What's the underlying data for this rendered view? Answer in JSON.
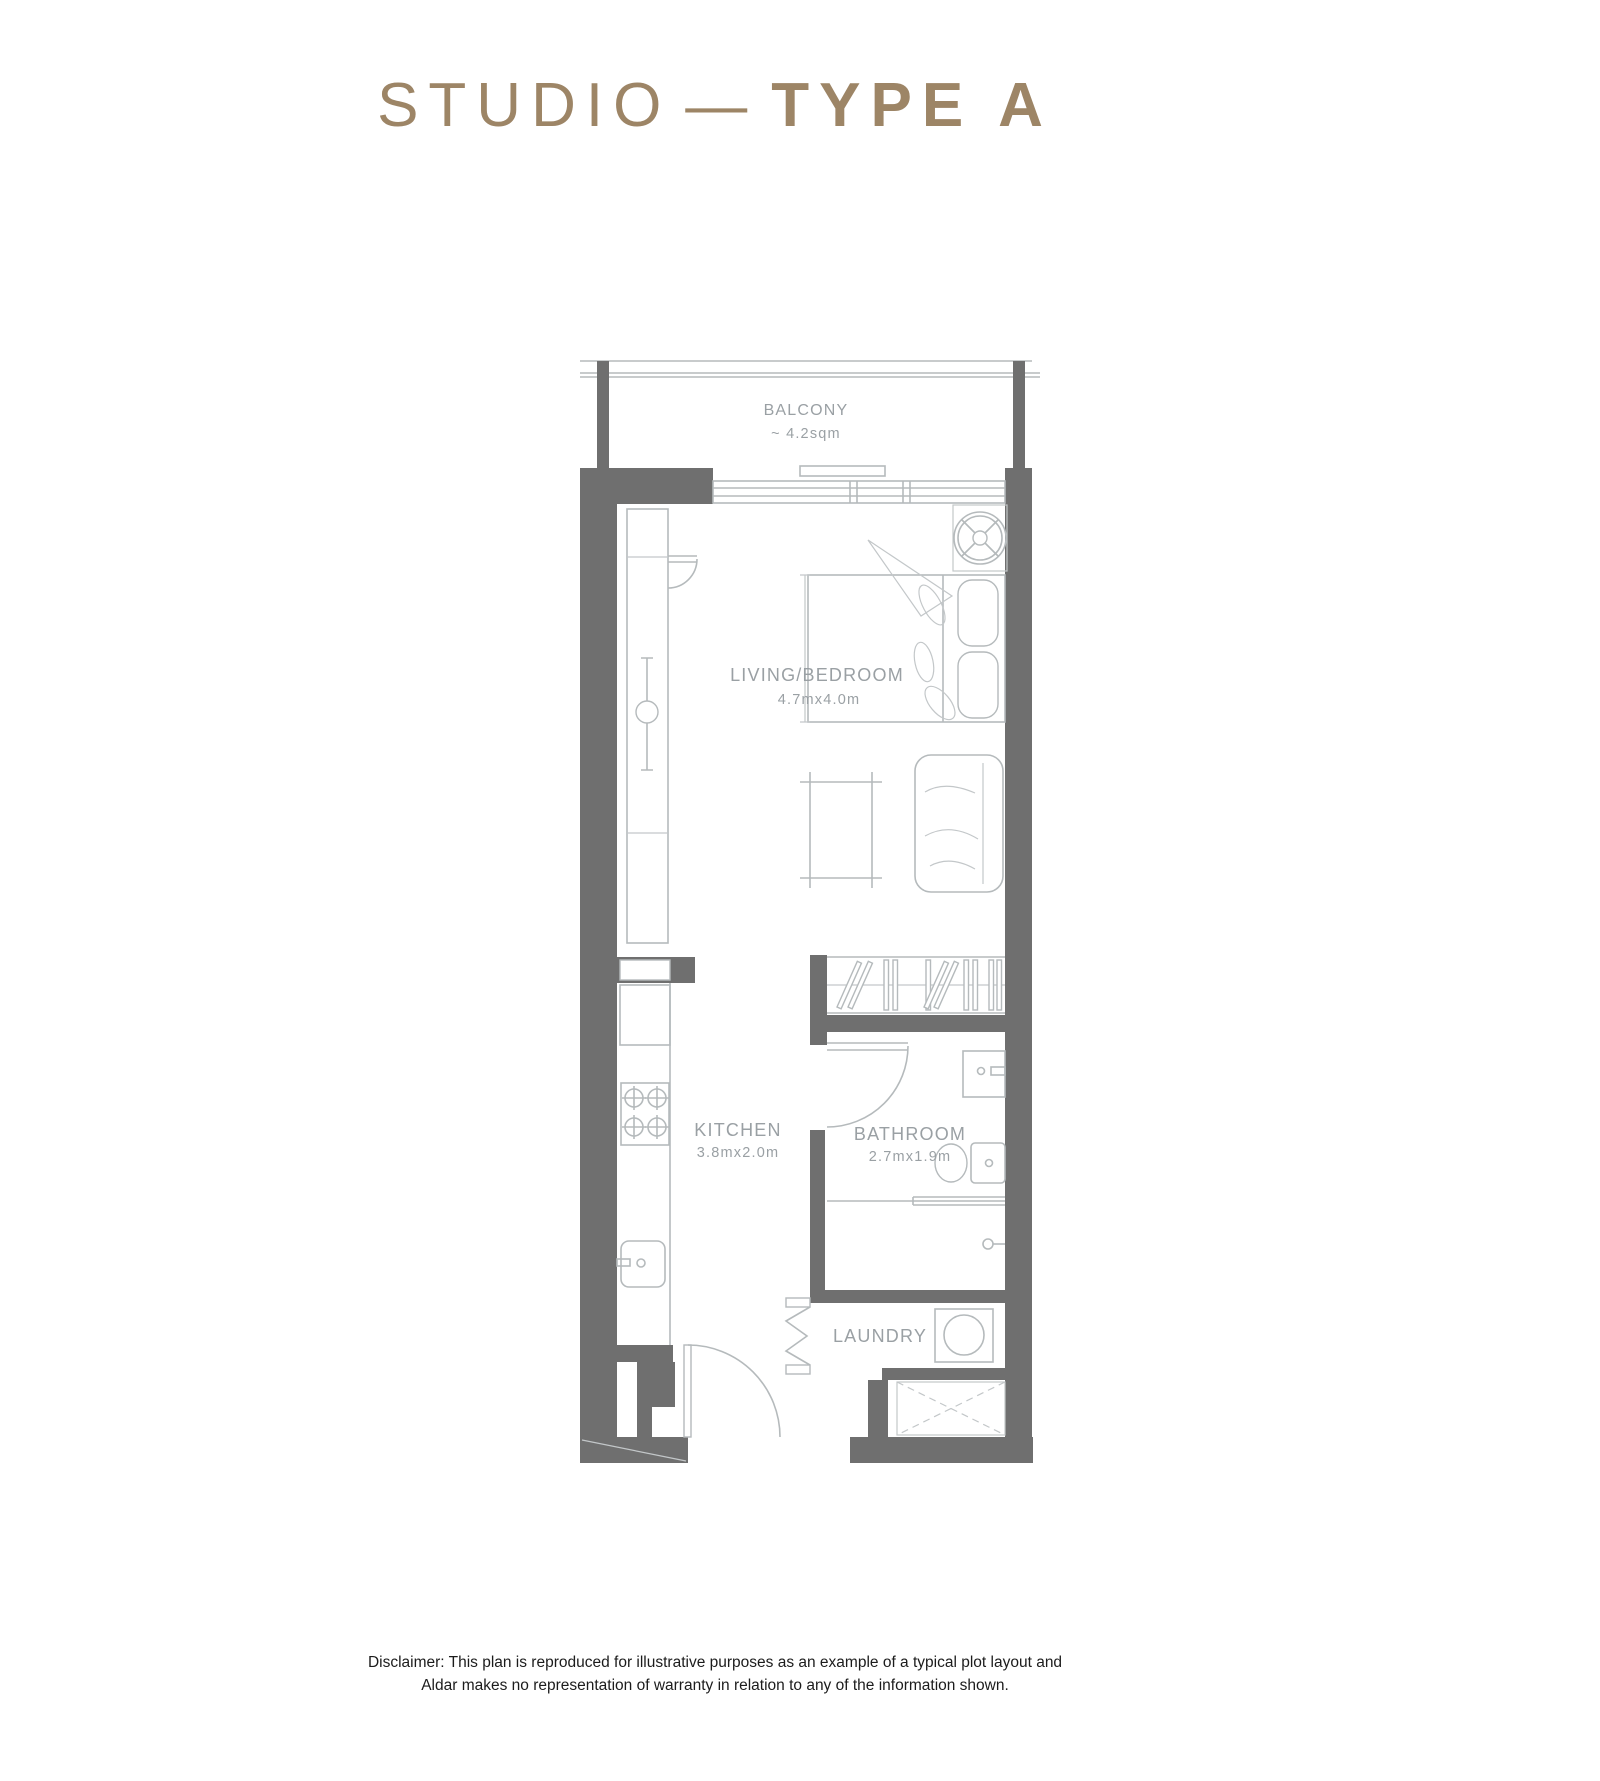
{
  "title": {
    "regular": "STUDIO",
    "dash": "—",
    "bold": "TYPE A"
  },
  "plan": {
    "balcony": {
      "name": "BALCONY",
      "area": "~ 4.2sqm"
    },
    "living_bedroom": {
      "name": "LIVING/BEDROOM",
      "dims": "4.7mx4.0m"
    },
    "kitchen": {
      "name": "KITCHEN",
      "dims": "3.8mx2.0m"
    },
    "bathroom": {
      "name": "BATHROOM",
      "dims": "2.7mx1.9m"
    },
    "laundry": {
      "name": "LAUNDRY"
    }
  },
  "disclaimer": {
    "line1": "Disclaimer: This plan is reproduced for illustrative purposes as an example of a typical plot layout and",
    "line2": "Aldar makes no representation of warranty in relation to any of the information shown."
  },
  "colors": {
    "title_accent": "#9d8566",
    "wall": "#6f6f6f",
    "plan_line": "#b5babc",
    "plan_label": "#9aa0a4",
    "disclaimer_text": "#1c1c1c",
    "background": "#ffffff"
  }
}
